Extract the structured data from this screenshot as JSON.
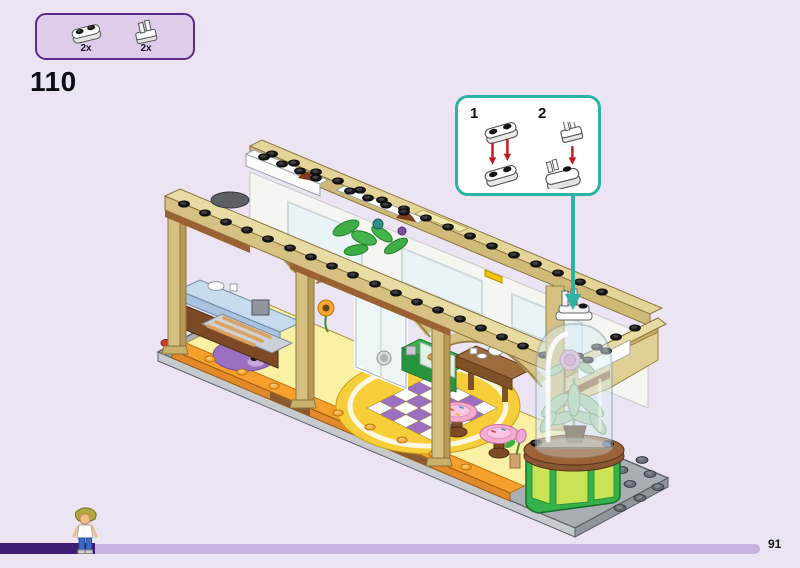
{
  "header": {
    "step_number": "110"
  },
  "parts_panel": {
    "items": [
      {
        "qty": "2x",
        "icon": "plate-1x2-round-white-icon"
      },
      {
        "qty": "2x",
        "icon": "plate-1x1-clip-white-icon"
      }
    ]
  },
  "callout": {
    "steps": [
      {
        "label": "1"
      },
      {
        "label": "2"
      }
    ]
  },
  "footer": {
    "page_number": "91"
  },
  "colors": {
    "bg": "#ece4f2",
    "panel-fill": "#ddcdeb",
    "panel-border": "#5b2b87",
    "callout-fill": "#ffffff",
    "callout-border": "#2bb3a4",
    "arrow-red": "#c4161d",
    "bar-dark": "#3f1d72",
    "bar-light": "#c6b2de"
  }
}
